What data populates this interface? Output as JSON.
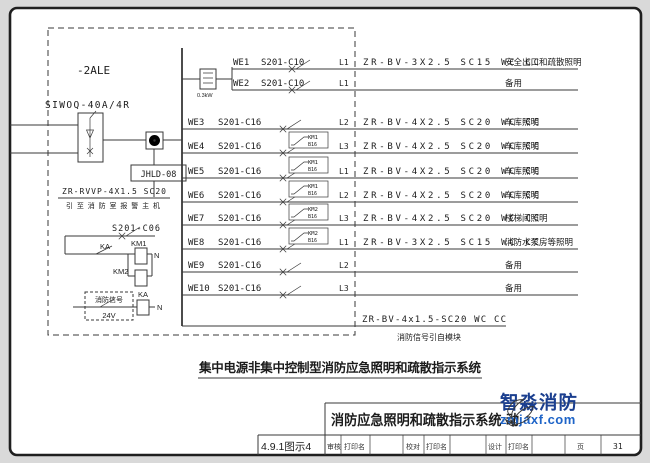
{
  "caption": "集中电源非集中控制型消防应急照明和疏散指示系统",
  "panel": {
    "name": "-2ALE",
    "incoming_breaker": "SIWOQ-40A/4R",
    "signal_module": "JHLD-08",
    "module_cable": "ZR-RVVP-4X1.5 SC20",
    "module_destination": "引至消防室报警主机",
    "control_breaker": "S201-C06",
    "inverter_rating": "0.3kW",
    "relay_label": "KA",
    "contactor1_label": "KM1",
    "contactor2_label": "KM2",
    "neutral_label": "N",
    "fire_signal_label": "消防信号",
    "fire_signal_voltage": "24V",
    "signal_cable": "ZR-BV-4x1.5-SC20 WC CC",
    "signal_cable_note": "消防信号引自模块"
  },
  "circuits": [
    {
      "id": "WE1",
      "breaker": "S201-C10",
      "phase": "L1",
      "cable": "ZR-BV-3X2.5 SC15 WC CC",
      "desc": "安全出口和疏散照明",
      "km": "",
      "km_sub": ""
    },
    {
      "id": "WE2",
      "breaker": "S201-C10",
      "phase": "L1",
      "cable": "",
      "desc": "备用",
      "km": "",
      "km_sub": ""
    },
    {
      "id": "WE3",
      "breaker": "S201-C16",
      "phase": "L2",
      "cable": "ZR-BV-4X2.5 SC20 WC CC",
      "desc": "车库照明",
      "km": "",
      "km_sub": ""
    },
    {
      "id": "WE4",
      "breaker": "S201-C16",
      "phase": "L3",
      "cable": "ZR-BV-4X2.5 SC20 WC CC",
      "desc": "车库照明",
      "km": "KM1",
      "km_sub": "B16"
    },
    {
      "id": "WE5",
      "breaker": "S201-C16",
      "phase": "L1",
      "cable": "ZR-BV-4X2.5 SC20 WC CC",
      "desc": "车库照明",
      "km": "KM1",
      "km_sub": "B16"
    },
    {
      "id": "WE6",
      "breaker": "S201-C16",
      "phase": "L2",
      "cable": "ZR-BV-4X2.5 SC20 WC CC",
      "desc": "车库照明",
      "km": "KM1",
      "km_sub": "B16"
    },
    {
      "id": "WE7",
      "breaker": "S201-C16",
      "phase": "L3",
      "cable": "ZR-BV-4X2.5 SC20 WC CC",
      "desc": "楼梯间照明",
      "km": "KM2",
      "km_sub": "B16"
    },
    {
      "id": "WE8",
      "breaker": "S201-C16",
      "phase": "L1",
      "cable": "ZR-BV-3X2.5 SC15 WC CC",
      "desc": "消防水泵房等照明",
      "km": "KM2",
      "km_sub": "B16"
    },
    {
      "id": "WE9",
      "breaker": "S201-C16",
      "phase": "L2",
      "cable": "",
      "desc": "备用",
      "km": "",
      "km_sub": ""
    },
    {
      "id": "WE10",
      "breaker": "S201-C16",
      "phase": "L3",
      "cable": "",
      "desc": "备用",
      "km": "",
      "km_sub": ""
    }
  ],
  "title_block": {
    "figure_no": "4.9.1图示4",
    "title": "消防应急照明和疏散指示系统·动",
    "review_label": "审核",
    "print_name": "打印名",
    "proof_label": "校对",
    "design_label": "设计",
    "page_label": "页",
    "page_number": "31"
  },
  "watermark": {
    "brand": "智淼消防",
    "site": "zmjaxf.com",
    "brand_color": "#1b3f8f",
    "site_color": "#1e64c8",
    "accent_color": "#f08c1e"
  }
}
